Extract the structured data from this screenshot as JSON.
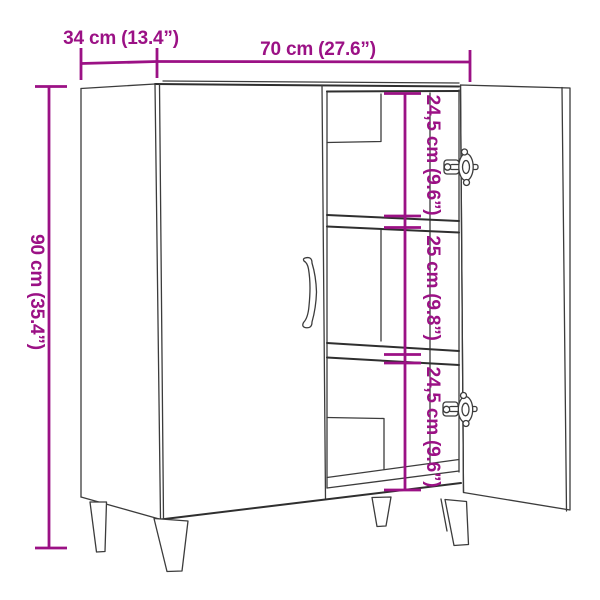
{
  "diagram": {
    "dimensions": {
      "depth": "34 cm (13.4”)",
      "width": "70 cm (27.6”)",
      "height": "90 cm (35.4”)",
      "inner_top": "24,5 cm (9.6”)",
      "inner_middle": "25 cm (9.8”)",
      "inner_bottom": "24,5 cm (9.6”)"
    },
    "colors": {
      "dimension_accent": "#9b1185",
      "outline": "#3c3c3c",
      "background": "#ffffff"
    }
  }
}
